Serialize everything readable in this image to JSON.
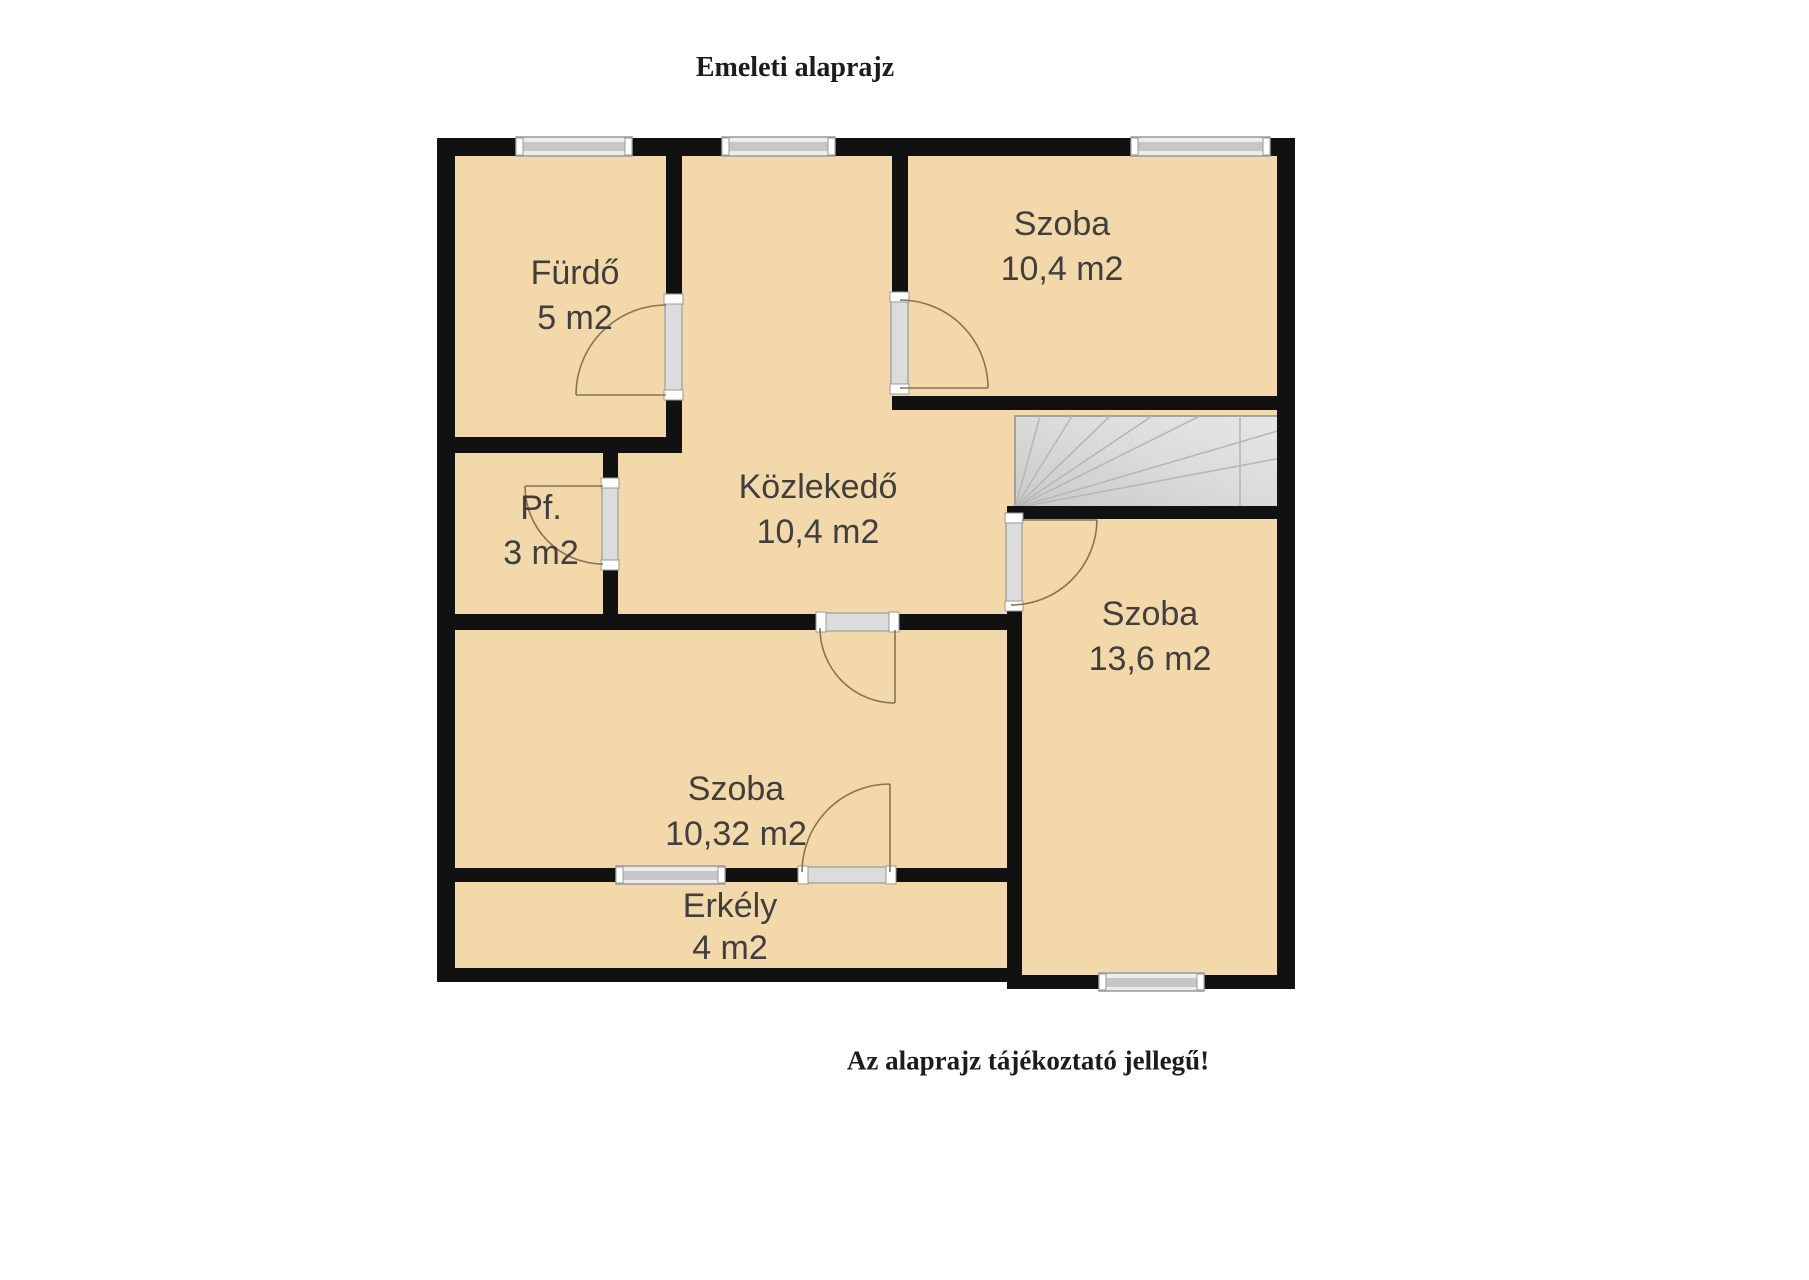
{
  "title": "Emeleti alaprajz",
  "note": "Az alaprajz tájékoztató jellegű!",
  "colors": {
    "room_fill": "#f3d9a9",
    "wall": "#111111",
    "window": "#c6c6c6",
    "door": "#dcdcdc",
    "stairs": "#d6d6d6",
    "label": "#3f3f3f",
    "text": "#1c1c1c"
  },
  "rooms": [
    {
      "id": "furdo",
      "name": "Fürdő",
      "area": "5 m2"
    },
    {
      "id": "pf",
      "name": "Pf.",
      "area": "3 m2"
    },
    {
      "id": "kozlekedo",
      "name": "Közlekedő",
      "area": "10,4 m2"
    },
    {
      "id": "szoba-felso",
      "name": "Szoba",
      "area": "10,4 m2"
    },
    {
      "id": "szoba-also",
      "name": "Szoba",
      "area": "10,32 m2"
    },
    {
      "id": "szoba-jobb",
      "name": "Szoba",
      "area": "13,6 m2"
    },
    {
      "id": "erkely",
      "name": "Erkély",
      "area": "4 m2"
    }
  ]
}
